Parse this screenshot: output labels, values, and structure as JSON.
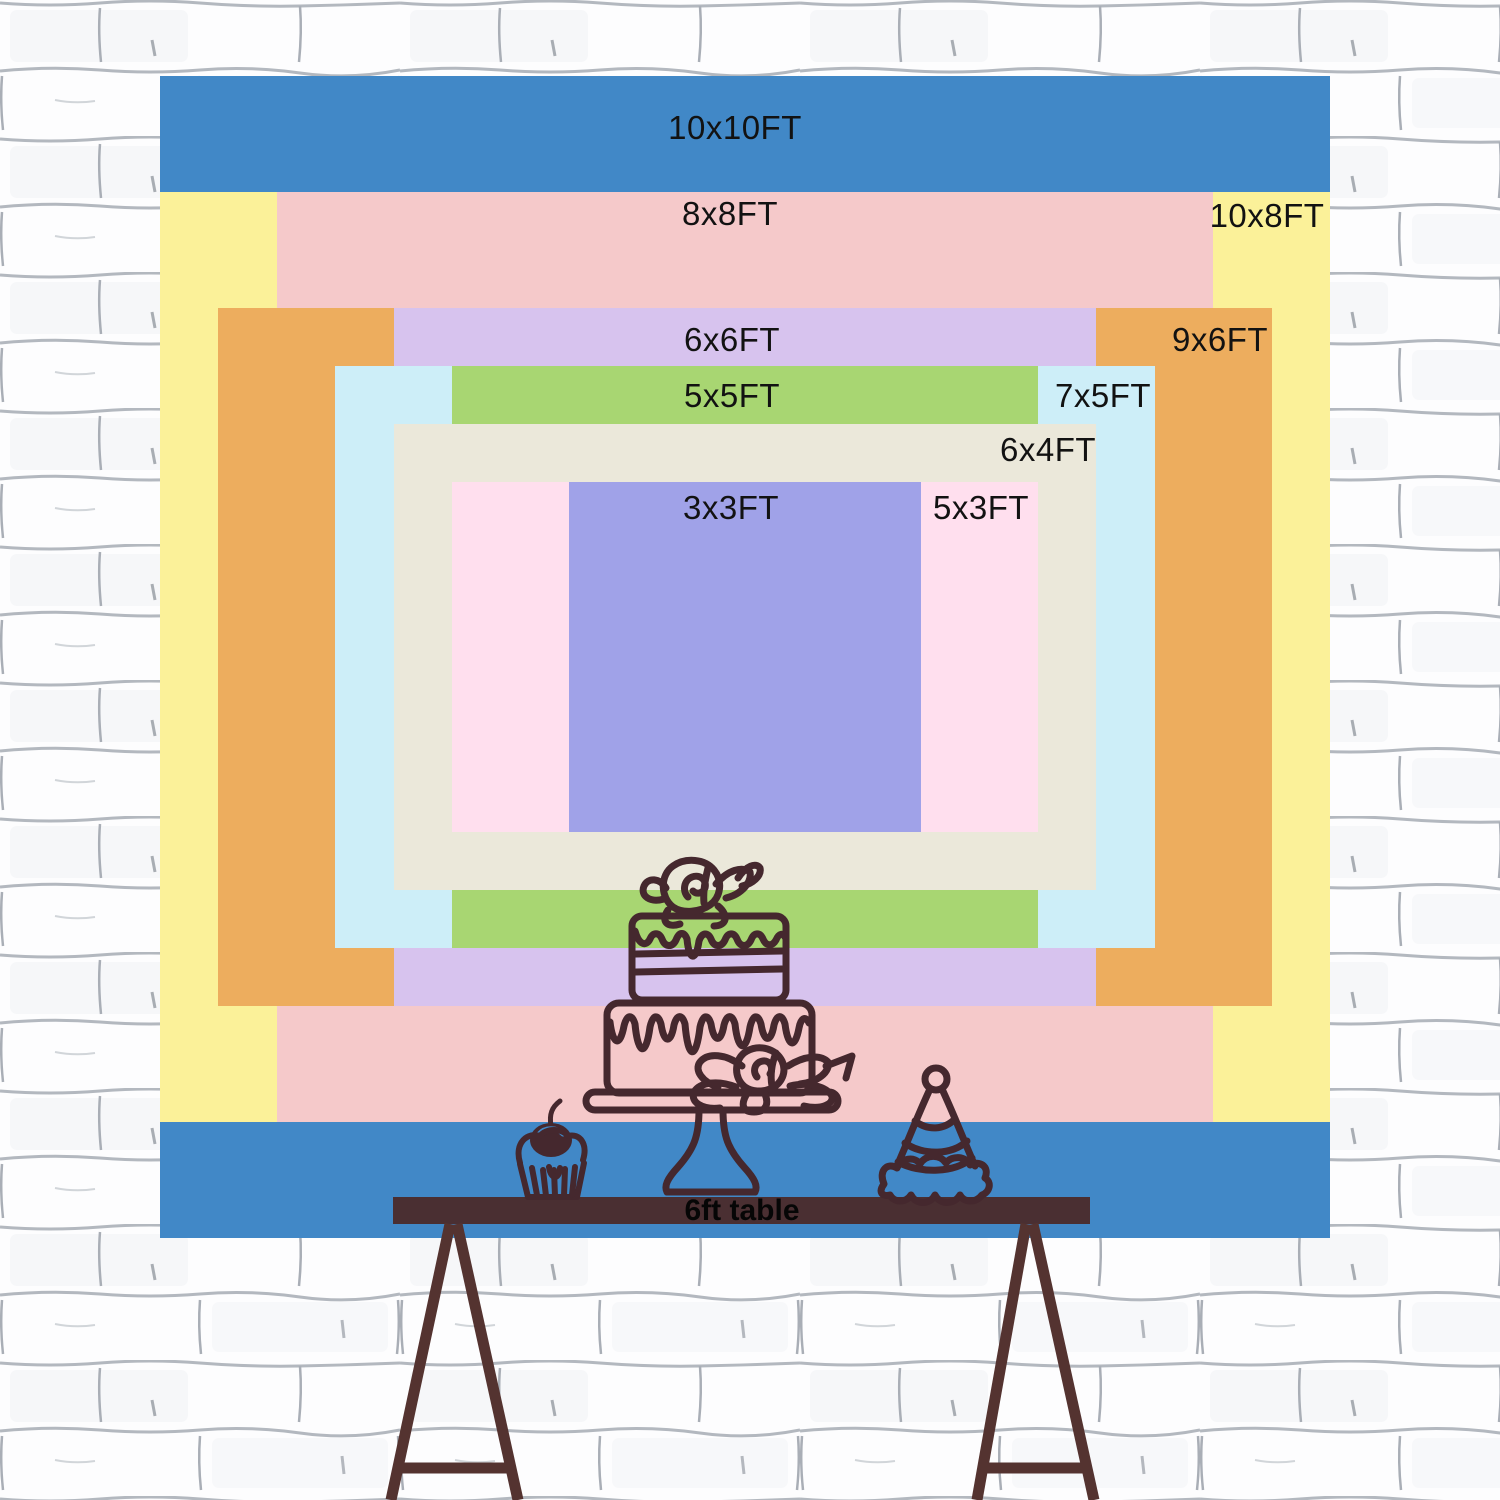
{
  "diagram": {
    "kind": "backdrop-size-comparison",
    "sizes": [
      {
        "label": "10x10FT",
        "width_ft": 10,
        "height_ft": 10,
        "color": "#4188c7",
        "label_placement": "top-center"
      },
      {
        "label": "10x8FT",
        "width_ft": 10,
        "height_ft": 8,
        "color": "#fbf199",
        "label_placement": "top-right"
      },
      {
        "label": "8x8FT",
        "width_ft": 8,
        "height_ft": 8,
        "color": "#f5c9ca",
        "label_placement": "top-center"
      },
      {
        "label": "9x6FT",
        "width_ft": 9,
        "height_ft": 6,
        "color": "#edad5e",
        "label_placement": "top-right"
      },
      {
        "label": "6x6FT",
        "width_ft": 6,
        "height_ft": 6,
        "color": "#d7c3ee",
        "label_placement": "top-center"
      },
      {
        "label": "7x5FT",
        "width_ft": 7,
        "height_ft": 5,
        "color": "#cdeef8",
        "label_placement": "top-right"
      },
      {
        "label": "5x5FT",
        "width_ft": 5,
        "height_ft": 5,
        "color": "#a8d672",
        "label_placement": "top-center"
      },
      {
        "label": "6x4FT",
        "width_ft": 6,
        "height_ft": 4,
        "color": "#ebe8da",
        "label_placement": "top-right"
      },
      {
        "label": "5x3FT",
        "width_ft": 5,
        "height_ft": 3,
        "color": "#ffdfee",
        "label_placement": "top-right"
      },
      {
        "label": "3x3FT",
        "width_ft": 3,
        "height_ft": 3,
        "color": "#a0a2e8",
        "label_placement": "top-center"
      }
    ],
    "table": {
      "label": "6ft table",
      "color": "#4a2f32",
      "leg_color": "#543330"
    },
    "decor": {
      "line_color": "#45282e",
      "items": [
        "tiered-birthday-cake",
        "cake-stand",
        "cupcake",
        "party-hat"
      ]
    },
    "wall": {
      "style": "white-sketched-brick",
      "mortar_color": "#b3b8bf"
    }
  }
}
